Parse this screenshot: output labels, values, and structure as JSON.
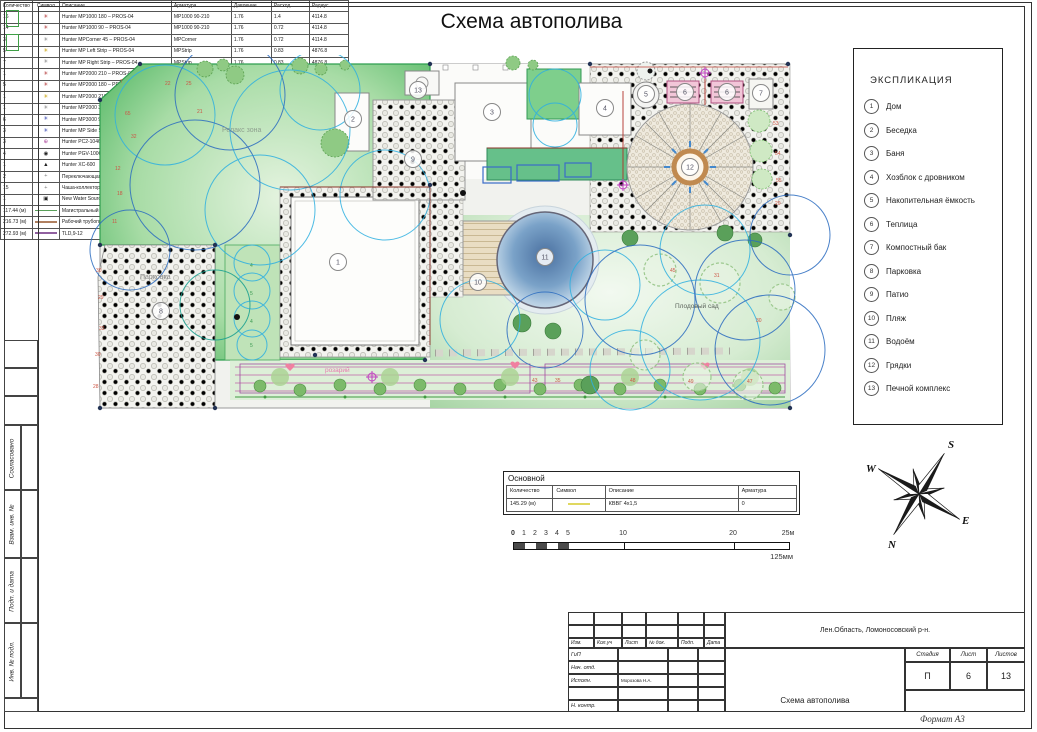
{
  "page": {
    "title": "Схема автополива",
    "format_label": "Формат А3"
  },
  "explication": {
    "title": "ЭКСПЛИКАЦИЯ",
    "items": [
      {
        "num": "1",
        "label": "Дом"
      },
      {
        "num": "2",
        "label": "Беседка"
      },
      {
        "num": "3",
        "label": "Баня"
      },
      {
        "num": "4",
        "label": "Хозблок с дровником"
      },
      {
        "num": "5",
        "label": "Накопительная ёмкость"
      },
      {
        "num": "6",
        "label": "Теплица"
      },
      {
        "num": "7",
        "label": "Компостный бак"
      },
      {
        "num": "8",
        "label": "Парковка"
      },
      {
        "num": "9",
        "label": "Патио"
      },
      {
        "num": "10",
        "label": "Пляж"
      },
      {
        "num": "11",
        "label": "Водоём"
      },
      {
        "num": "12",
        "label": "Грядки"
      },
      {
        "num": "13",
        "label": "Печной комплекс"
      }
    ]
  },
  "plan": {
    "area_labels": [
      {
        "text": "Релакс зона",
        "x": 137,
        "y": 77,
        "color": "#8fa08f",
        "size": 7
      },
      {
        "text": "Парковка",
        "x": 55,
        "y": 224,
        "color": "#8a8a8a",
        "size": 7
      },
      {
        "text": "розарий",
        "x": 240,
        "y": 317,
        "color": "#e878b0",
        "size": 6.5
      },
      {
        "text": "Плодовый сад",
        "x": 590,
        "y": 253,
        "color": "#5a625a",
        "size": 6.5
      }
    ],
    "markers": [
      {
        "n": "1",
        "x": 253,
        "y": 207
      },
      {
        "n": "2",
        "x": 268,
        "y": 64
      },
      {
        "n": "3",
        "x": 407,
        "y": 57
      },
      {
        "n": "4",
        "x": 520,
        "y": 53
      },
      {
        "n": "5",
        "x": 561,
        "y": 39
      },
      {
        "n": "6",
        "x": 600,
        "y": 37
      },
      {
        "n": "6",
        "x": 642,
        "y": 37
      },
      {
        "n": "7",
        "x": 676,
        "y": 38
      },
      {
        "n": "8",
        "x": 76,
        "y": 256
      },
      {
        "n": "9",
        "x": 328,
        "y": 104
      },
      {
        "n": "10",
        "x": 393,
        "y": 227
      },
      {
        "n": "11",
        "x": 460,
        "y": 202
      },
      {
        "n": "12",
        "x": 605,
        "y": 112
      },
      {
        "n": "13",
        "x": 333,
        "y": 35
      }
    ],
    "plant_labels": [
      {
        "t": "7",
        "x": 35,
        "y": 28
      },
      {
        "t": "22",
        "x": 80,
        "y": 30
      },
      {
        "t": "25",
        "x": 101,
        "y": 30
      },
      {
        "t": "65",
        "x": 40,
        "y": 60
      },
      {
        "t": "21",
        "x": 112,
        "y": 58
      },
      {
        "t": "32",
        "x": 46,
        "y": 83
      },
      {
        "t": "12",
        "x": 30,
        "y": 115
      },
      {
        "t": "18",
        "x": 32,
        "y": 140
      },
      {
        "t": "11",
        "x": 27,
        "y": 168
      },
      {
        "t": "30",
        "x": 11,
        "y": 217
      },
      {
        "t": "29",
        "x": 13,
        "y": 244
      },
      {
        "t": "33",
        "x": 14,
        "y": 275
      },
      {
        "t": "30",
        "x": 10,
        "y": 301
      },
      {
        "t": "28",
        "x": 8,
        "y": 333
      },
      {
        "t": "53",
        "x": 688,
        "y": 70
      },
      {
        "t": "54",
        "x": 690,
        "y": 100
      },
      {
        "t": "55",
        "x": 691,
        "y": 127
      },
      {
        "t": "20",
        "x": 690,
        "y": 150
      },
      {
        "t": "45",
        "x": 585,
        "y": 217
      },
      {
        "t": "31",
        "x": 629,
        "y": 222
      },
      {
        "t": "30",
        "x": 671,
        "y": 267
      },
      {
        "t": "48",
        "x": 545,
        "y": 327
      },
      {
        "t": "49",
        "x": 603,
        "y": 328
      },
      {
        "t": "47",
        "x": 662,
        "y": 328
      },
      {
        "t": "43",
        "x": 447,
        "y": 327
      },
      {
        "t": "35",
        "x": 470,
        "y": 327
      },
      {
        "t": "4",
        "x": 165,
        "y": 212,
        "c": "#3a9a50"
      },
      {
        "t": "5",
        "x": 165,
        "y": 240,
        "c": "#3a9a50"
      },
      {
        "t": "4",
        "x": 165,
        "y": 268,
        "c": "#3a9a50"
      },
      {
        "t": "5",
        "x": 165,
        "y": 292,
        "c": "#3a9a50"
      }
    ]
  },
  "equipment_table": {
    "headers": [
      "Количество",
      "Символ",
      "Описание",
      "Арматура",
      "Давление",
      "Расход",
      "Радиус"
    ],
    "rows": [
      {
        "qty": "16",
        "sym": "nozzle-red",
        "desc": "Hunter MP1000 180 – PROS-04",
        "arm": "MP1000 90-210",
        "pres": "1.76",
        "flow": "1.4",
        "rad": "4114.8"
      },
      {
        "qty": "14",
        "sym": "nozzle-red",
        "desc": "Hunter MP1000 90 – PROS-04",
        "arm": "MP1000 90-210",
        "pres": "1.76",
        "flow": "0.72",
        "rad": "4114.8"
      },
      {
        "qty": "3",
        "sym": "nozzle-gray",
        "desc": "Hunter MPCorner 45 – PROS-04",
        "arm": "MPCorner",
        "pres": "1.76",
        "flow": "0.72",
        "rad": "4114.8"
      },
      {
        "qty": "5",
        "sym": "nozzle-yellow",
        "desc": "Hunter MP Left Strip – PROS-04",
        "arm": "MPStrip",
        "pres": "1.76",
        "flow": "0.83",
        "rad": "4876.8"
      },
      {
        "qty": "7",
        "sym": "nozzle-gray",
        "desc": "Hunter MP Right Strip – PROS-04",
        "arm": "MPStrip",
        "pres": "1.76",
        "flow": "0.83",
        "rad": "4876.8"
      },
      {
        "qty": "1",
        "sym": "nozzle-red",
        "desc": "Hunter MP2000 210 – PROS-04",
        "arm": "MP2000 90-210",
        "pres": "1.76",
        "flow": "3.26",
        "rad": "5791.2"
      },
      {
        "qty": "5",
        "sym": "nozzle-red",
        "desc": "Hunter MP2000 180 – PROS-04",
        "arm": "MP2000 90-210",
        "pres": "1.76",
        "flow": "6.89",
        "rad": "9144"
      },
      {
        "qty": "1",
        "sym": "nozzle-yellow",
        "desc": "Hunter MP2000 210 – PROS-04",
        "arm": "MP2000 90-210",
        "pres": "1.76",
        "flow": "8.03",
        "rad": "9144"
      },
      {
        "qty": "1",
        "sym": "nozzle-gray",
        "desc": "Hunter MP2000 360 – PROS-04",
        "arm": "MP2000 360",
        "pres": "1.76",
        "flow": "13.78",
        "rad": "9144"
      },
      {
        "qty": "6",
        "sym": "nozzle-blue",
        "desc": "Hunter MP3000 90 – PROS-04",
        "arm": "MP3000 90-210",
        "pres": "1.76",
        "flow": "3.26",
        "rad": "9144"
      },
      {
        "qty": "3",
        "sym": "nozzle-blue",
        "desc": "Hunter MP Side Strip – PROS-04",
        "arm": "MPStrip",
        "pres": "1.76",
        "flow": "1.67",
        "rad": "9753.6"
      },
      {
        "qty": "3",
        "sym": "rotor-magenta",
        "desc": "Hunter PC2-1046",
        "arm": "PC2-1046",
        "pres": "",
        "flow": "",
        "rad": ""
      },
      {
        "qty": "4",
        "sym": "valve-black",
        "desc": "Hunter PGV-100G",
        "arm": "PGV-100G",
        "pres": "",
        "flow": "",
        "rad": ""
      },
      {
        "qty": "1",
        "sym": "controller-black",
        "desc": "Hunter XC-600",
        "arm": "XC-600",
        "pres": "",
        "flow": "",
        "rad": ""
      },
      {
        "qty": "2",
        "sym": "marker-dot",
        "desc": "Переключающаяся ёмкость 2 000 мл. арм.",
        "arm": "",
        "pres": "",
        "flow": "",
        "rad": ""
      },
      {
        "qty": "15",
        "sym": "marker-dot",
        "desc": "Чаша-коллектор капельных шлангов",
        "arm": "",
        "pres": "",
        "flow": "",
        "rad": ""
      },
      {
        "qty": "1",
        "sym": "water-source",
        "desc": "New Water Source",
        "arm": "",
        "pres": "",
        "flow": "",
        "rad": ""
      },
      {
        "qty": "117.44 (м)",
        "sym": "line-green",
        "desc": "Магистральный трубопровод - 25мм",
        "arm": "0",
        "pres": "",
        "flow": "",
        "rad": ""
      },
      {
        "qty": "216.73 (м)",
        "sym": "line-brown",
        "desc": "Рабочий трубопровод - 25мм",
        "arm": "0",
        "pres": "",
        "flow": "",
        "rad": ""
      },
      {
        "qty": "272.93 (м)",
        "sym": "line-purple",
        "desc": "TLD,9-12",
        "arm": "TLD,9-12",
        "pres": "0",
        "flow": "0",
        "rad": ""
      }
    ]
  },
  "symbols": {
    "nozzle-red": {
      "glyph": "✳",
      "color": "#b03030"
    },
    "nozzle-yellow": {
      "glyph": "✳",
      "color": "#c8a000"
    },
    "nozzle-gray": {
      "glyph": "✳",
      "color": "#808080"
    },
    "nozzle-blue": {
      "glyph": "✳",
      "color": "#3040b0"
    },
    "rotor-magenta": {
      "glyph": "⊕",
      "color": "#b050a0"
    },
    "valve-black": {
      "glyph": "◉",
      "color": "#202020"
    },
    "controller-black": {
      "glyph": "▲",
      "color": "#202020"
    },
    "marker-dot": {
      "glyph": "+",
      "color": "#808080"
    },
    "water-source": {
      "glyph": "▣",
      "color": "#202020"
    },
    "line-green": {
      "color": "#5aa05a"
    },
    "line-brown": {
      "color": "#b08060"
    },
    "line-purple": {
      "color": "#9060a0"
    },
    "line-yellow": {
      "color": "#e0d860"
    }
  },
  "main_table": {
    "title": "Основной",
    "headers": [
      "Количество",
      "Символ",
      "Описание",
      "Арматура"
    ],
    "row": {
      "qty": "145.29 (м)",
      "sym": "line-yellow",
      "desc": "КВВГ 4х1,5",
      "arm": "0"
    }
  },
  "scale_bar": {
    "ticks": [
      {
        "label": "0",
        "m": 0
      },
      {
        "label": "1",
        "m": 1
      },
      {
        "label": "2",
        "m": 2
      },
      {
        "label": "3",
        "m": 3
      },
      {
        "label": "4",
        "m": 4
      },
      {
        "label": "5",
        "m": 5
      },
      {
        "label": "10",
        "m": 10
      },
      {
        "label": "20",
        "m": 20
      },
      {
        "label": "25м",
        "m": 25
      }
    ],
    "sub_label": "125мм"
  },
  "compass": {
    "n": "N",
    "e": "E",
    "s": "S",
    "w": "W"
  },
  "title_block": {
    "region": "Лен.Область, Ломоносовский р-н.",
    "doc": "Схема автополива",
    "cols": [
      "Изм.",
      "Кол.уч",
      "Лист",
      "№ док.",
      "Подп.",
      "Дата"
    ],
    "role_rows": [
      "ГиП",
      "Нач. отд.",
      "Исполн.",
      "",
      "Н. контр."
    ],
    "executor": "Морозова Н.А.",
    "stage_label": "Стадия",
    "sheet_label": "Лист",
    "sheets_label": "Листов",
    "stage": "П",
    "sheet": "6",
    "sheets": "13"
  },
  "side_stamp": {
    "labels": [
      "Согласовано",
      "Взам. инв. №",
      "Подп. и дата",
      "Инв. № подл."
    ]
  }
}
